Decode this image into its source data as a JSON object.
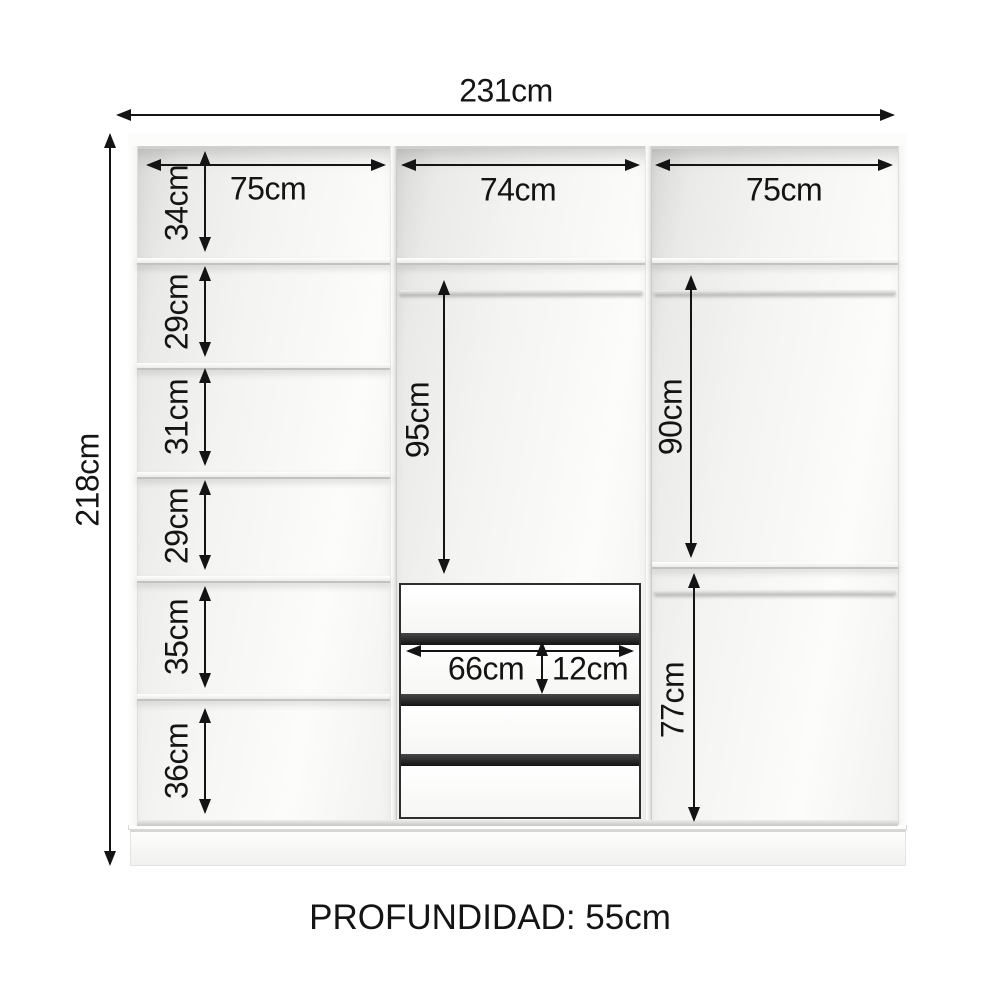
{
  "diagram": {
    "overall": {
      "width": "231cm",
      "height": "218cm"
    },
    "depth_label": "PROFUNDIDAD: 55cm",
    "sections": {
      "left": "75cm",
      "middle": "74cm",
      "right": "75cm"
    },
    "left_shelves": [
      "34cm",
      "29cm",
      "31cm",
      "29cm",
      "35cm",
      "36cm"
    ],
    "middle": {
      "hanging": "95cm",
      "drawer_width": "66cm",
      "drawer_height": "12cm"
    },
    "right": {
      "hanging_top": "90cm",
      "hanging_bottom": "77cm"
    },
    "colors": {
      "line": "#141414",
      "drawer_gap": "#232323",
      "interior": "#f1f1ef"
    }
  }
}
